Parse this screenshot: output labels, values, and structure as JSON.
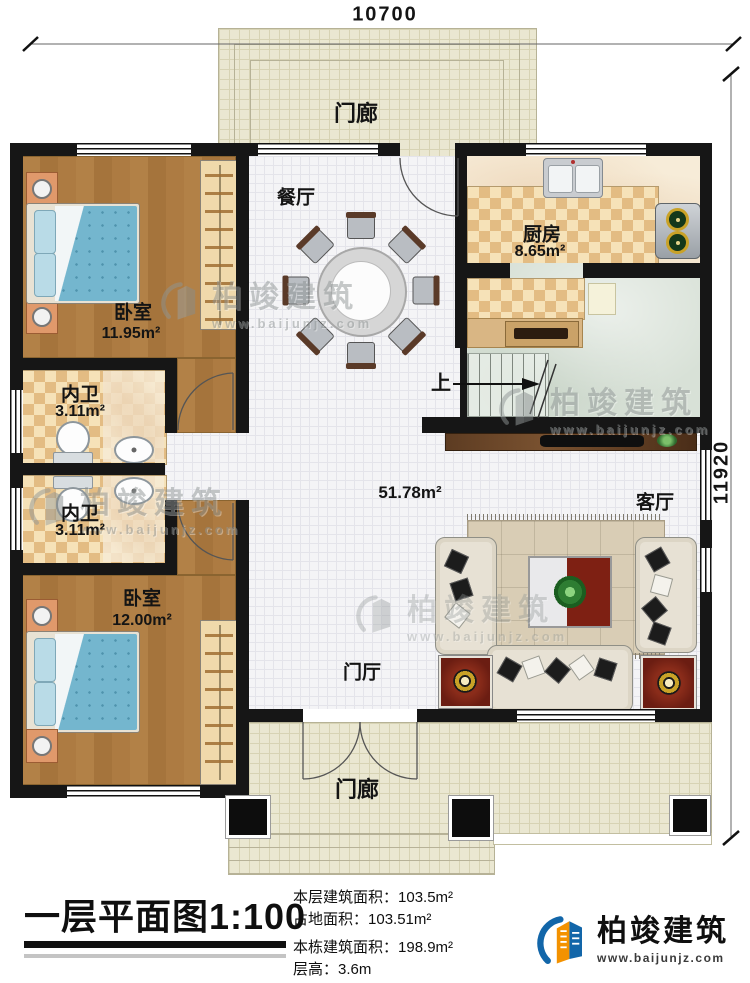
{
  "plan": {
    "dim_width": "10700",
    "dim_height": "11920",
    "rooms": {
      "porch_top": "门廊",
      "dining": "餐厅",
      "kitchen_name": "厨房",
      "kitchen_area": "8.65m²",
      "bedroom1_name": "卧室",
      "bedroom1_area": "11.95m²",
      "bath1_name": "内卫",
      "bath1_area": "3.11m²",
      "bath2_name": "内卫",
      "bath2_area": "3.11m²",
      "bedroom2_name": "卧室",
      "bedroom2_area": "12.00m²",
      "hall_area": "51.78m²",
      "living": "客厅",
      "foyer": "门厅",
      "porch_bottom": "门廊",
      "stairs_up": "上"
    }
  },
  "titleblock": {
    "title": "一层平面图1:100",
    "info": [
      {
        "label": "本层建筑面积：",
        "value": "103.5m²"
      },
      {
        "label": "占地面积：",
        "value": "103.51m²"
      },
      {
        "label": "本栋建筑面积：",
        "value": "198.9m²"
      },
      {
        "label": "层高：",
        "value": "3.6m"
      }
    ],
    "brand_name": "柏竣建筑",
    "brand_url": "www.baijunjz.com"
  },
  "watermark": {
    "name": "柏竣建筑",
    "url": "www.baijunjz.com"
  },
  "colors": {
    "brand_blue": "#1266a9",
    "brand_orange": "#f39200",
    "wall": "#161616"
  }
}
